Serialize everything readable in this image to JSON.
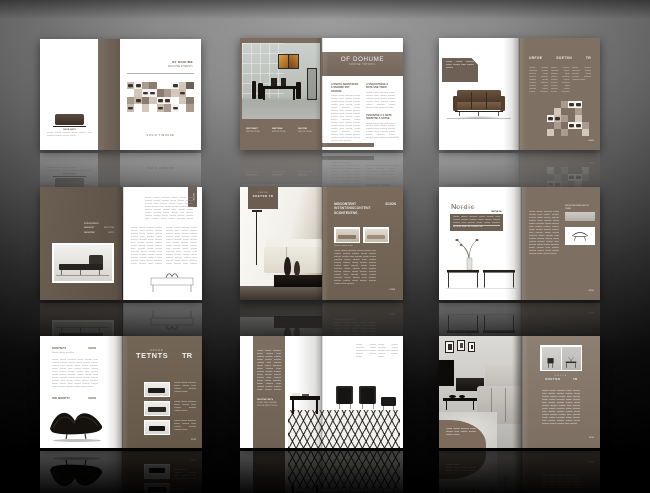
{
  "palette": {
    "brown_dark": "#5f5348",
    "brown": "#6e6156",
    "brown_mid": "#7b6e62",
    "brown_light": "#8a7d70",
    "taupe": "#a99b8d",
    "taupe_light": "#d2c7ba",
    "page_white": "#ffffff"
  },
  "mosaic_colors": {
    ".": "transparent",
    "w": "#ffffff",
    "a": "#d2c7ba",
    "b": "#a99b8d",
    "c": "#8a7c6e",
    "d": "#6e6156",
    "F": "#f4f2ee",
    "G": "#c9bdb0"
  },
  "mosaics": {
    "s1": {
      "cell": 7.4,
      "rows": [
        "GFbc..Fad",
        ".aFFcbaG.",
        "bGcaFF.ac",
        "G.a.GbF.b"
      ]
    },
    "s3": {
      "cell": 7,
      "rows": [
        "..bFF.",
        ".a..b.",
        "FGb.a.",
        ".b.FFb",
        "a.b..a"
      ]
    }
  },
  "fillers": {
    "long": "Sionte snetse nonsitse intsen sitsnoe tsnei sonitse nestion snoitse ntsnie stnoise ontsnei snoitse intse noestni sionte snetse nonsitse intsen sitsnoe tsnei sonitse nestion snoitse ntsnie stnoise ontsnei snoitse intse noestni sionte snetse nonsitse intsen sitsnoe tsnei sonitse nestion snoitse ntsnie stnoise ontsnei snoitse intse noestni sionte snetse nonsitse intsen sitsnoe tsnei sonitse nestion snoitse ntsnie stnoise ontsnei snoitse intse noestni.",
    "med": "Sionte snetse nonsitse intsen sitsnoe tsnei sonitse nestion snoitse ntsnie stnoise ontsnei snoitse intse noestni sionte snetse nonsitse intsen sitsnoe tsnei sonitse nestion.",
    "short": "Sionte snetse nonsitse intsen sitsnoe tsnei sonitse nestion snoitse ntsnie.",
    "tinyline": "Sionte snetse nonsitse"
  },
  "s1": {
    "back_caption_title": "SNOE SNTS",
    "title1": "OF DOHUME",
    "title2": "DRUCHSE INTERSTL",
    "footer": "SOVIO TIMOUNE"
  },
  "s2": {
    "header_title": "OF DOHUME",
    "header_sub": "SIONSE TNTSNTL",
    "col1_heading": "A SNOTE SNONTSESN E SNONSE SNT SCNONE",
    "col2_heading": "A SNQONTSESE A SNTE SNE TSNOI",
    "col2_mid": "TSNONTSE A S SNTE SNONTSE A SNTSE",
    "captions": [
      {
        "t": "SNOTSNET",
        "s": "SNTSE NTSE"
      },
      {
        "t": "SNETSNE",
        "s": "SNTSE NTSE"
      },
      {
        "t": "SNOTSE",
        "s": "SNTSE NTSE"
      }
    ],
    "page_no": "02/03"
  },
  "s3": {
    "label_text": "Sionte snetse nonsitse intsen sitsnoe tsnei sonitse nestion",
    "h": [
      "URFOE",
      "SOETSN",
      "TR"
    ],
    "page_no": "04/05"
  },
  "s4": {
    "specs": [
      {
        "label": "NTSONTSETS",
        "value": ""
      },
      {
        "label": "SNONTST",
        "value": "SNTSTSE"
      },
      {
        "label": "SNONTSE",
        "value": "SNTS"
      }
    ],
    "tab": "SNTSE"
  },
  "s5": {
    "tab1": "URFOE",
    "tab2": "SOETSN TR",
    "h1a": "NISCONTENT",
    "h1b": "SCION",
    "h2": "INTSNTSNISCONTENT",
    "h3": "SCONTENTNS",
    "caption": "Sionte snetse nons",
    "page_no": "07/08"
  },
  "s6": {
    "title_cap": "N",
    "title_rest": "ordic",
    "subtitle": "Nordic Furniture Series",
    "box_caption": "SNTSE NL",
    "box_footer": "SIONTE SNETSE NONSITSE",
    "right_caption": "SNONTSETSNE SNTST TSNE",
    "page_no": "09/10"
  },
  "s7": {
    "h1a": "SIONTSETS",
    "h1b": "SCION",
    "h2a": "SNE SNONTST",
    "h2b": "SCION",
    "brand_small": "URFDE",
    "brand_big1": "TETNTS",
    "brand_big2": "TR",
    "page_no": "11/12"
  },
  "s8": {
    "stripe_h": "SNOITSE SNTS",
    "stripe_l1": "NTSE SNOI SNTSE",
    "stripe_l2": "SNTSE SNTS NTSE",
    "page_no": "13/14"
  },
  "s9": {
    "brand_small": "URFOE",
    "brand1": "SOETSN",
    "brand2": "TR",
    "page_no": "15/16"
  }
}
